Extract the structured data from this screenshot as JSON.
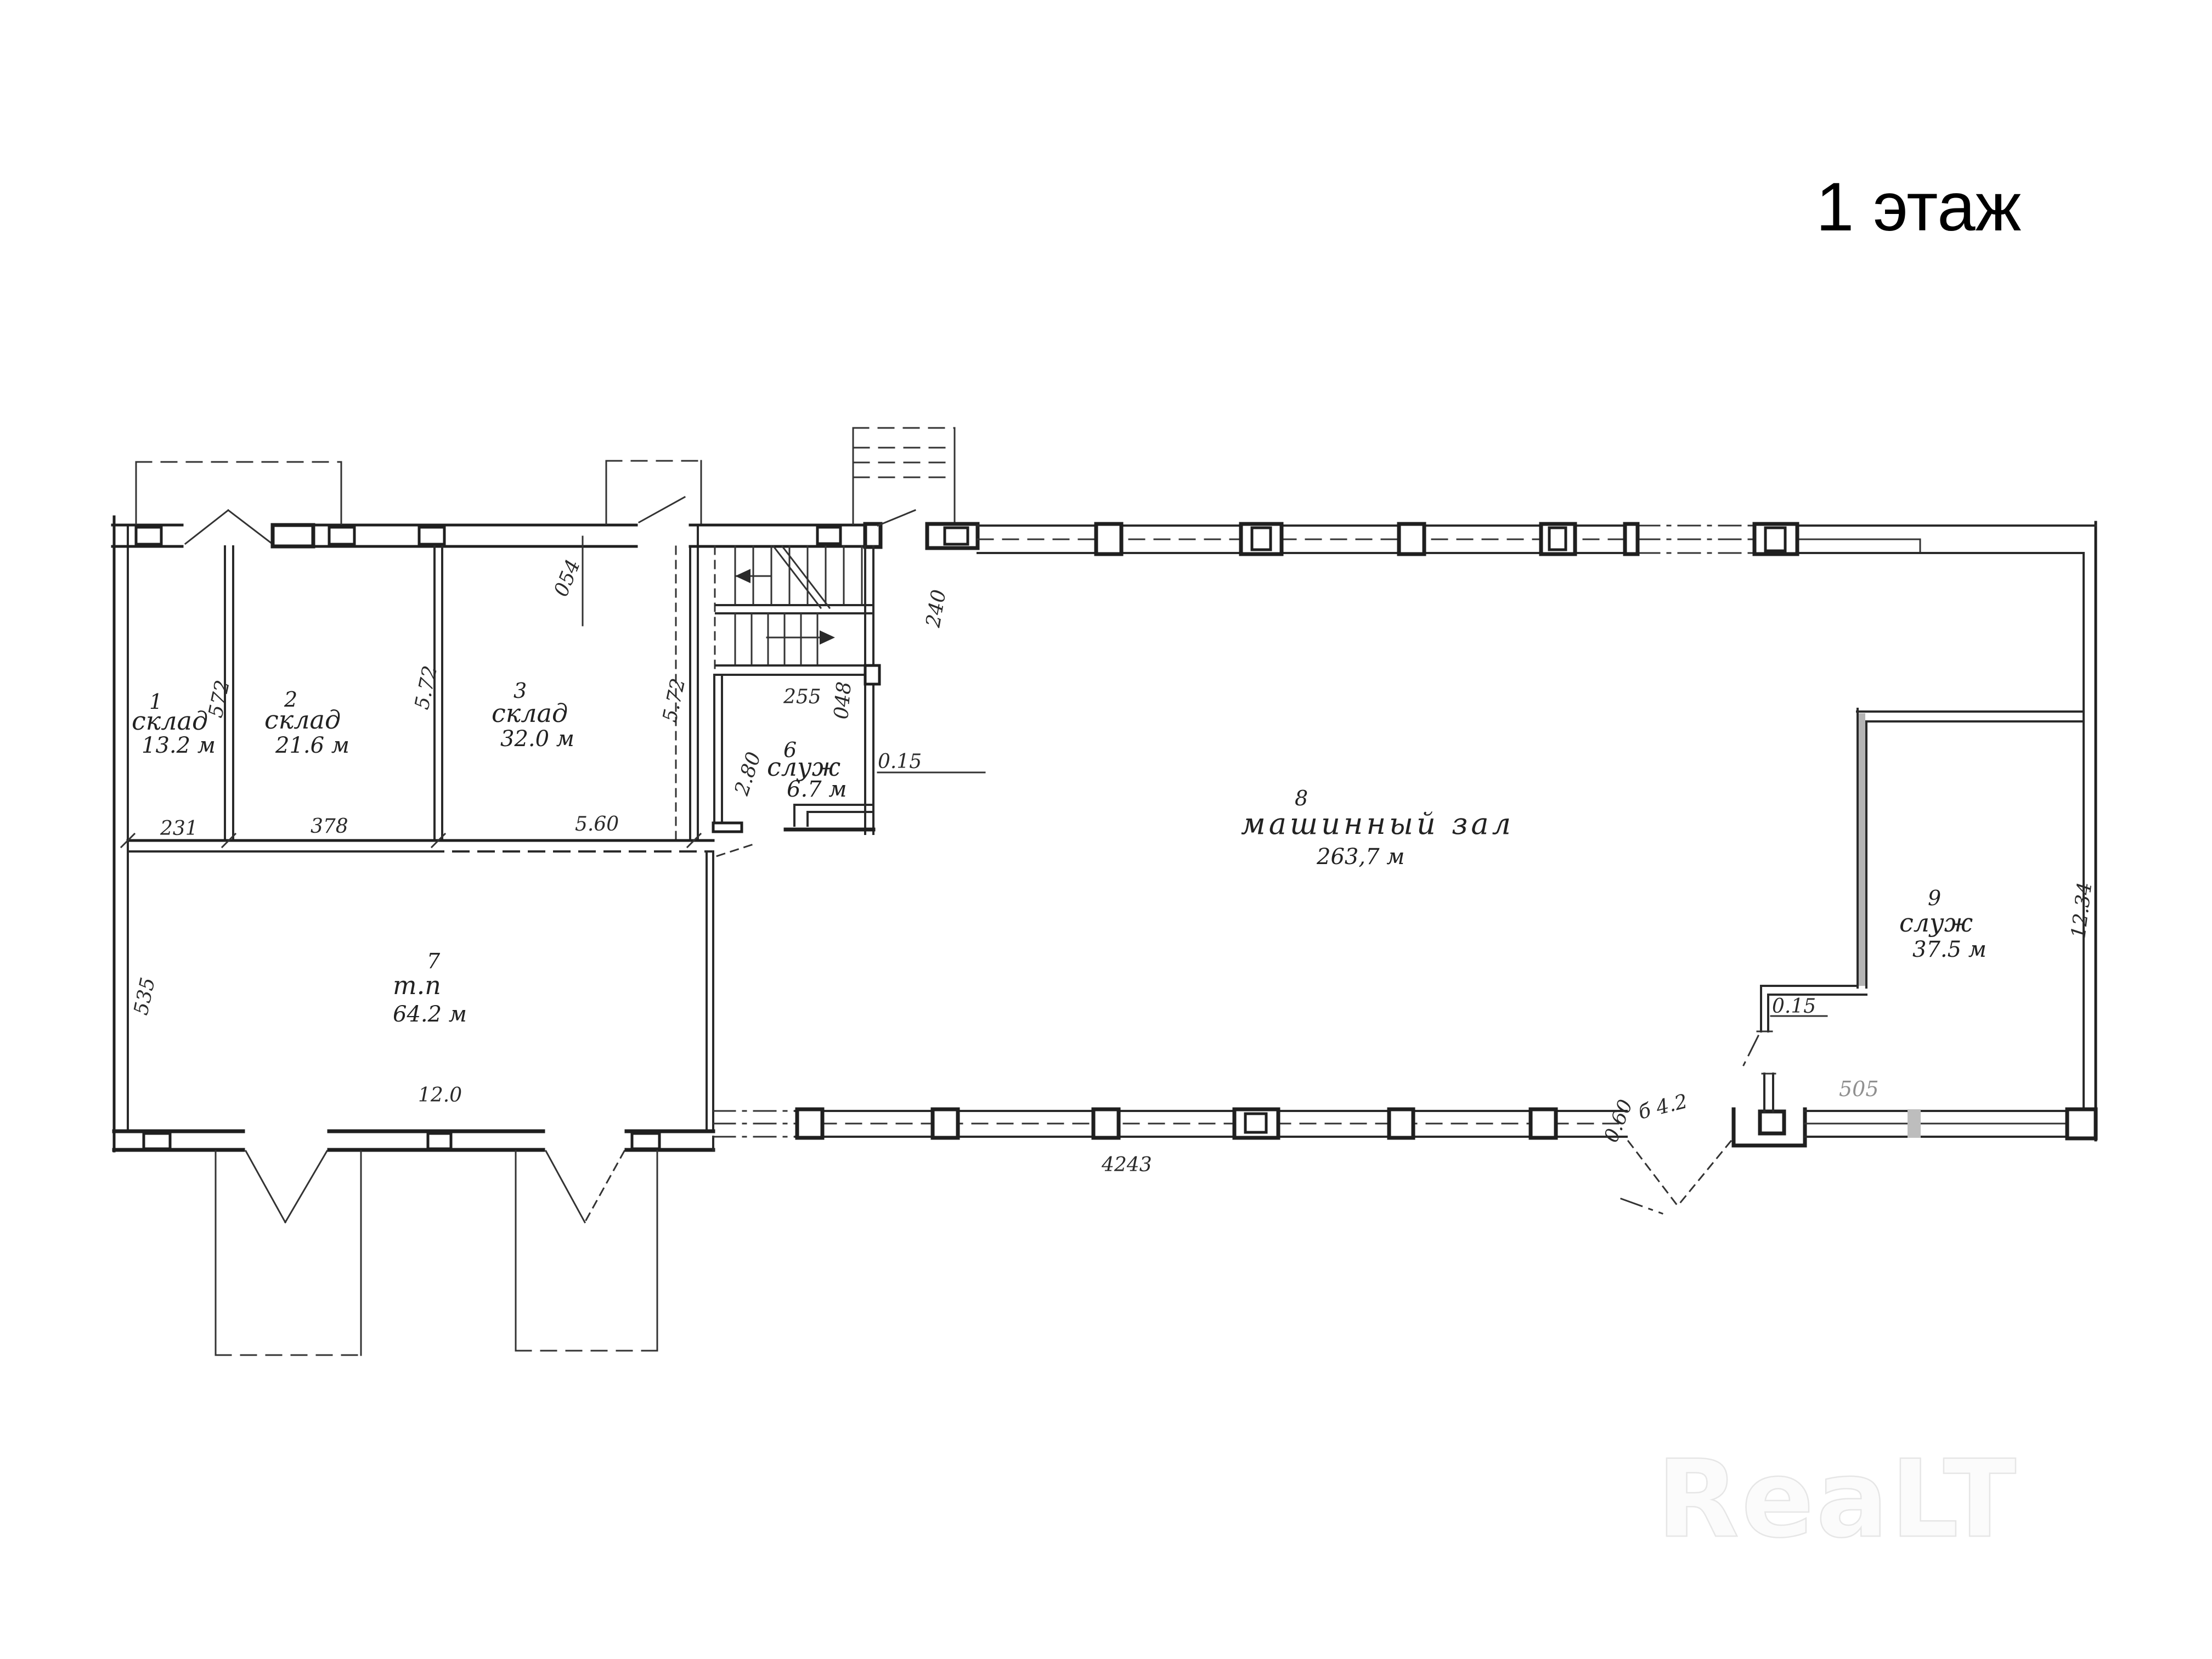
{
  "page": {
    "title": "1 этаж",
    "watermark": "ReaLT"
  },
  "plan": {
    "rooms": [
      {
        "number": "1",
        "name": "склад",
        "area": "13.2 м"
      },
      {
        "number": "2",
        "name": "склад",
        "area": "21.6 м"
      },
      {
        "number": "3",
        "name": "склад",
        "area": "32.0 м"
      },
      {
        "number": "6",
        "name": "служ",
        "area": "6.7 м"
      },
      {
        "number": "7",
        "name": "т.п",
        "area": "64.2 м"
      },
      {
        "number": "8",
        "name": "машинный зал",
        "area": "263,7 м"
      },
      {
        "number": "9",
        "name": "служ",
        "area": "37.5 м"
      }
    ],
    "dims": {
      "d572": "572",
      "d572b": "5.72",
      "d572c": "5.72",
      "d054": "054",
      "d255": "255",
      "d048": "048",
      "d240": "240",
      "d280": "2.80",
      "d015": "0.15",
      "d231": "231",
      "d378": "378",
      "d560": "5.60",
      "d535": "535",
      "d120": "12.0",
      "d4243": "4243",
      "d060": "0.60",
      "d42": "б 4.2",
      "d015b": "0.15",
      "d505": "505",
      "d1234": "12.34"
    }
  }
}
